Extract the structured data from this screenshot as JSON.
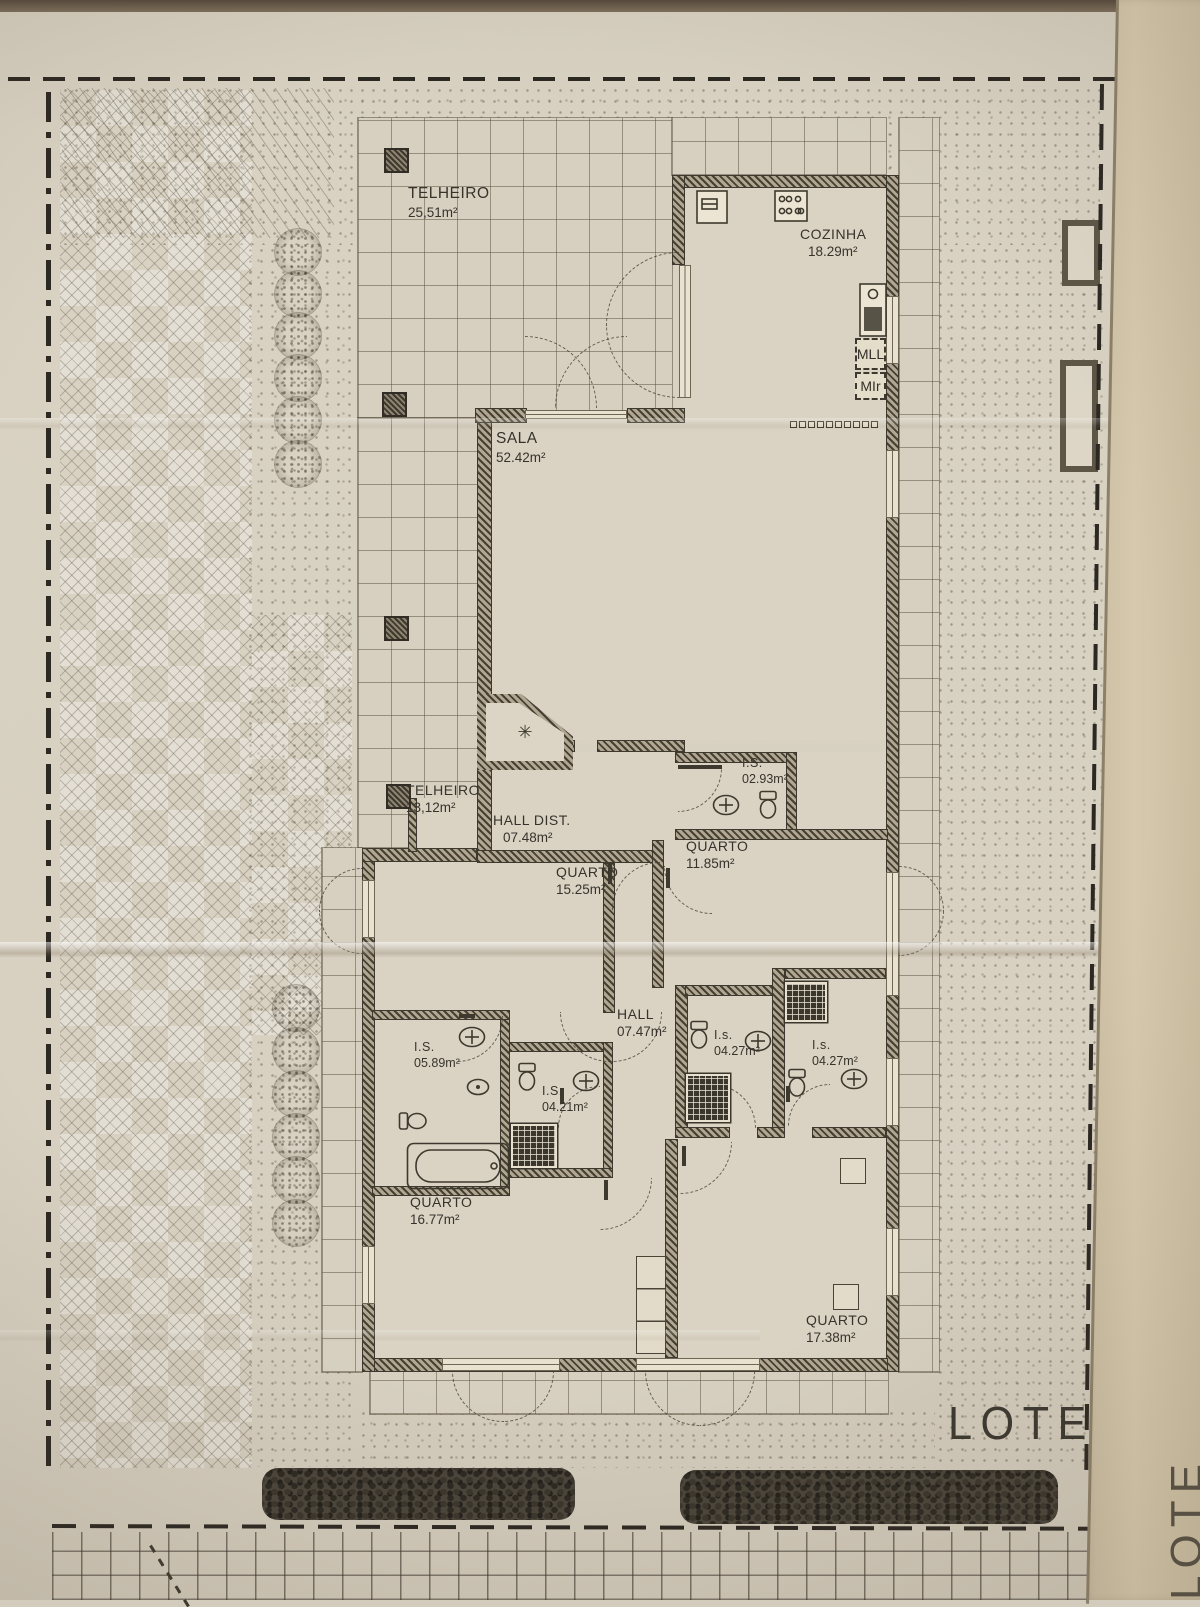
{
  "colors": {
    "paper": "#d8d1c2",
    "fold_paper": "#cfc2a6",
    "ink": "#3b372e",
    "wall": "#464033",
    "hedge": "#2c2922"
  },
  "rooms": [
    {
      "name": "TELHEIRO",
      "area": "25,51m²"
    },
    {
      "name": "COZINHA",
      "area": "18.29m²"
    },
    {
      "name": "SALA",
      "area": "52.42m²"
    },
    {
      "name": "TELHEIRO",
      "area": "13,12m²"
    },
    {
      "name": "HALL DIST.",
      "area": "07.48m²"
    },
    {
      "name": "I.S.",
      "area": "02.93m²"
    },
    {
      "name": "QUARTO",
      "area": "11.85m²"
    },
    {
      "name": "QUARTO",
      "area": "15.25m²"
    },
    {
      "name": "HALL",
      "area": "07.47m²"
    },
    {
      "name": "I.S.",
      "area": "05.89m²"
    },
    {
      "name": "I.S.",
      "area": "04.21m²"
    },
    {
      "name": "I.s.",
      "area": "04.27m²"
    },
    {
      "name": "I.s.",
      "area": "04.27m²"
    },
    {
      "name": "QUARTO",
      "area": "16.77m²"
    },
    {
      "name": "QUARTO",
      "area": "17.38m²"
    }
  ],
  "appliances": {
    "mll": "MLL",
    "mlr": "MIr"
  },
  "lots": {
    "lote1": "LOTE 1",
    "lote2": "LOTE 2"
  },
  "symbols": {
    "fireplace": "✳"
  },
  "icons": [
    "toilet-icon",
    "sink-icon",
    "bidet-icon",
    "bathtub-icon",
    "shower-icon",
    "stove-icon",
    "cabinet-icon",
    "water-heater-icon",
    "tree-icon",
    "hedge-icon"
  ]
}
